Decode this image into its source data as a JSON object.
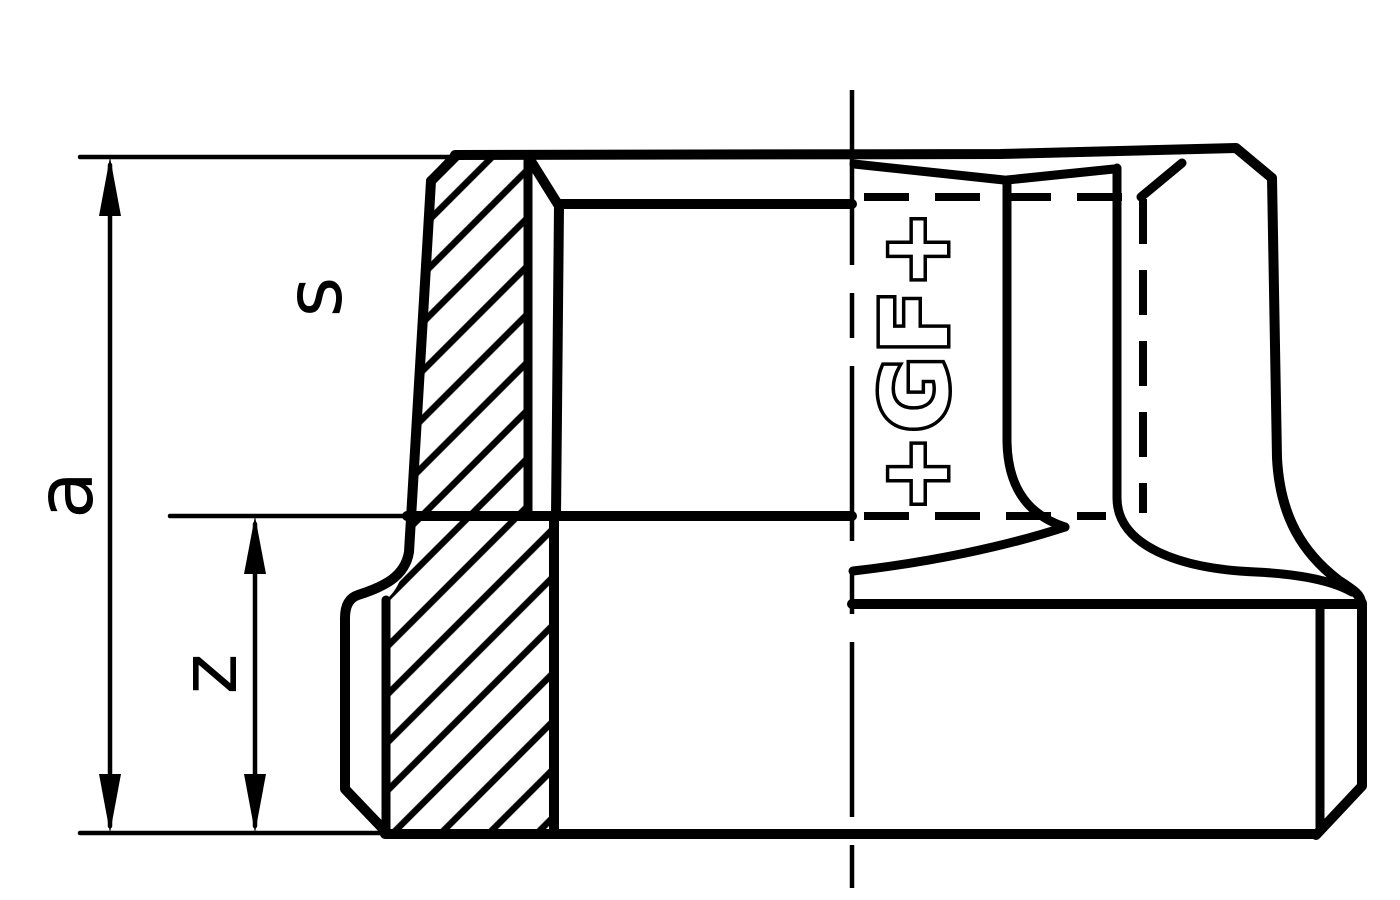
{
  "diagram": {
    "title": "threaded-fitting-half-section",
    "dimension_labels": {
      "overall_height": "a",
      "thread_length": "z",
      "across_flats": "s"
    },
    "logo_text": "+GF+",
    "colors": {
      "line": "#000000",
      "background": "#ffffff"
    }
  }
}
